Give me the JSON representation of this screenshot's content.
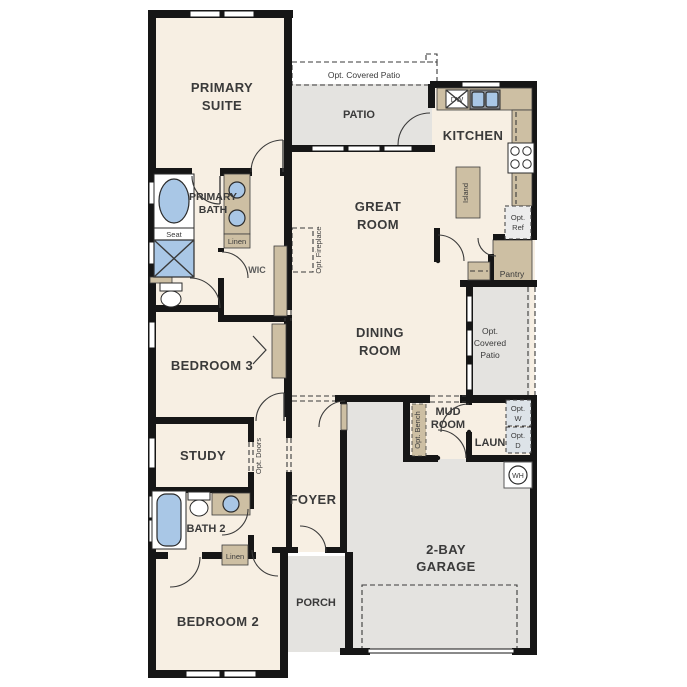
{
  "plan_title": "Single-story residential floor plan",
  "colors": {
    "floor": "#f7efe3",
    "outdoor": "#e4e3e0",
    "cabinet": "#cdbfa3",
    "fixture_blue": "#a9c7e6",
    "wall": "#161616"
  },
  "rooms": {
    "primary_suite": {
      "line1": "PRIMARY",
      "line2": "SUITE"
    },
    "primary_bath": {
      "line1": "PRIMARY",
      "line2": "BATH"
    },
    "wic": {
      "label": "WIC"
    },
    "bedroom3": {
      "label": "BEDROOM 3"
    },
    "study": {
      "label": "STUDY"
    },
    "bath2": {
      "label": "BATH 2"
    },
    "bedroom2": {
      "label": "BEDROOM 2"
    },
    "great_room": {
      "line1": "GREAT",
      "line2": "ROOM"
    },
    "dining_room": {
      "line1": "DINING",
      "line2": "ROOM"
    },
    "kitchen": {
      "label": "KITCHEN"
    },
    "patio": {
      "label": "PATIO"
    },
    "foyer": {
      "label": "FOYER"
    },
    "porch": {
      "label": "PORCH"
    },
    "garage": {
      "line1": "2-BAY",
      "line2": "GARAGE"
    },
    "mud_room": {
      "line1": "MUD",
      "line2": "ROOM"
    },
    "laundry": {
      "label": "LAUN"
    }
  },
  "features": {
    "opt_covered_patio_top": "Opt. Covered Patio",
    "opt_covered_patio_right": {
      "line1": "Opt.",
      "line2": "Covered",
      "line3": "Patio"
    },
    "opt_fireplace": "Opt. Fireplace",
    "island": "Island",
    "pantry": "Pantry",
    "opt_ref": {
      "line1": "Opt.",
      "line2": "Ref"
    },
    "opt_bench": "Opt. Bench",
    "opt_doors": "Opt. Doors",
    "opt_washer": {
      "line1": "Opt.",
      "line2": "W"
    },
    "opt_dryer": {
      "line1": "Opt.",
      "line2": "D"
    },
    "seat": "Seat",
    "linen_primary": "Linen",
    "linen_bath2": "Linen",
    "dishwasher": "DW",
    "water_heater": "WH"
  }
}
